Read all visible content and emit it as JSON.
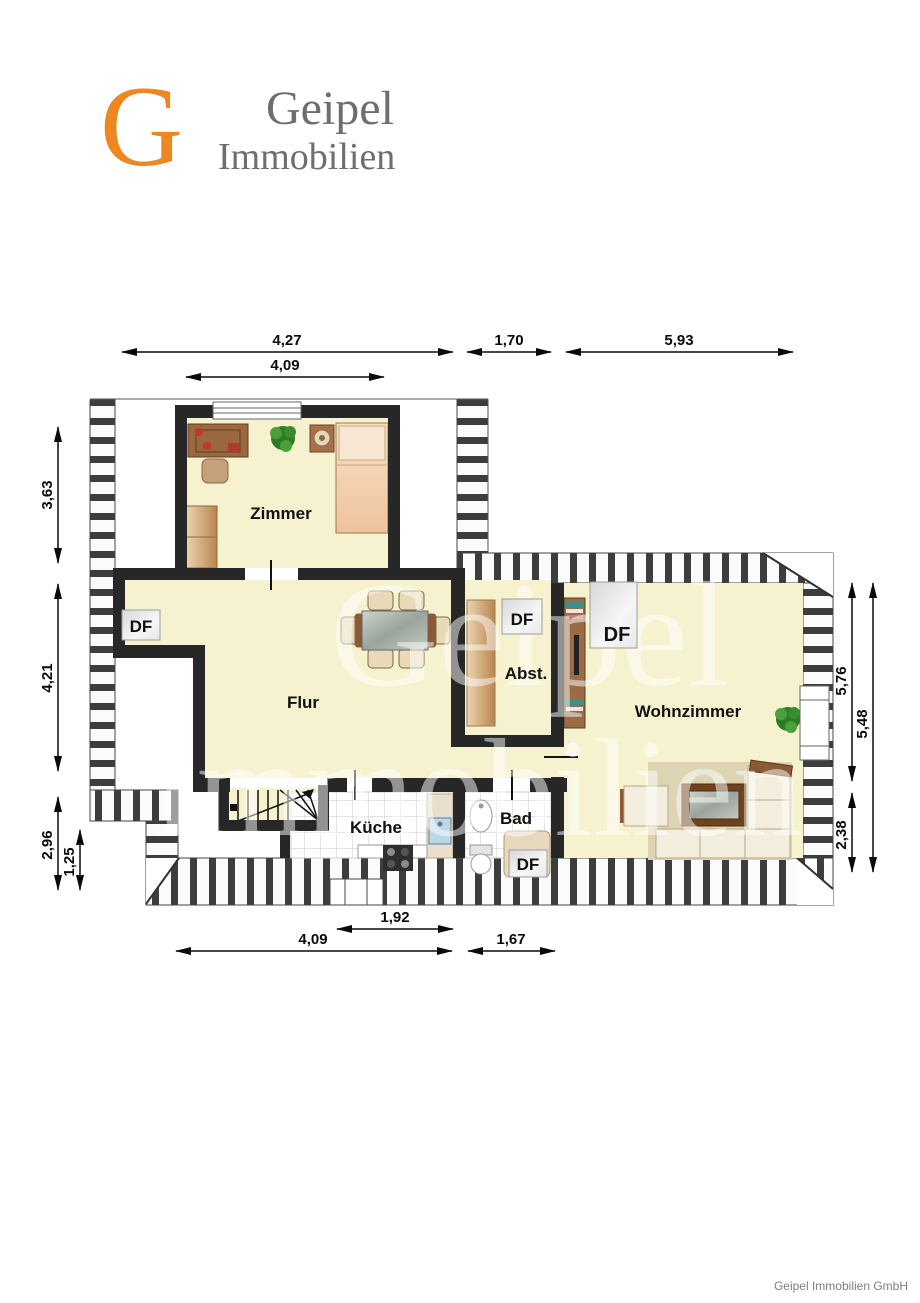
{
  "logo": {
    "letter": "G",
    "name_top": "Geipel",
    "name_bottom": "Immobilien"
  },
  "watermark": {
    "line1": "Geipel",
    "line2": "Immobilien"
  },
  "footer": {
    "text": "Geipel Immobilien GmbH"
  },
  "labels": {
    "df": "DF",
    "rooms": {
      "zimmer": "Zimmer",
      "flur": "Flur",
      "abst": "Abst.",
      "wohnzimmer": "Wohnzimmer",
      "kueche": "Küche",
      "bad": "Bad"
    }
  },
  "dimensions": {
    "top": [
      "4,27",
      "1,70",
      "5,93",
      "4,09"
    ],
    "bottom": [
      "1,92",
      "4,09",
      "1,67"
    ],
    "left": [
      "3,63",
      "4,21",
      "2,96",
      "1,25"
    ],
    "right": [
      "5,76",
      "5,48",
      "2,38"
    ]
  },
  "colors": {
    "accent_orange": "#ED8722",
    "wall": "#272727",
    "room_fill": "#F6F2CF",
    "hatch": "#3d3d3d"
  }
}
